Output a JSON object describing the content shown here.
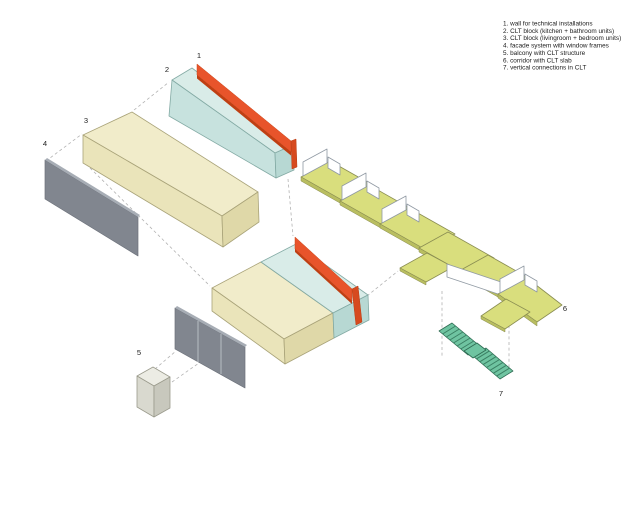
{
  "diagram": {
    "labels": [
      "1",
      "2",
      "3",
      "4",
      "5",
      "6",
      "7"
    ],
    "legend": {
      "items": [
        "1. wall for technical installations",
        "2. CLT block (kitchen + bathroom units)",
        "3. CLT block (livingroom + bedroom units)",
        "4. facade system with window frames",
        "5. balcony with CLT structure",
        "6. corridor with CLT slab",
        "7. vertical connections in CLT"
      ]
    },
    "colors": {
      "orange_wall": "#e8542b",
      "clt_kitchen_teal": "#cfe7e3",
      "clt_living_cream": "#f1ecca",
      "facade_gray": "#81868f",
      "corridor_yellow": "#d9de7d",
      "stairs_green": "#6fc4a1",
      "railing_white": "#ffffff",
      "background": "#ffffff"
    }
  }
}
